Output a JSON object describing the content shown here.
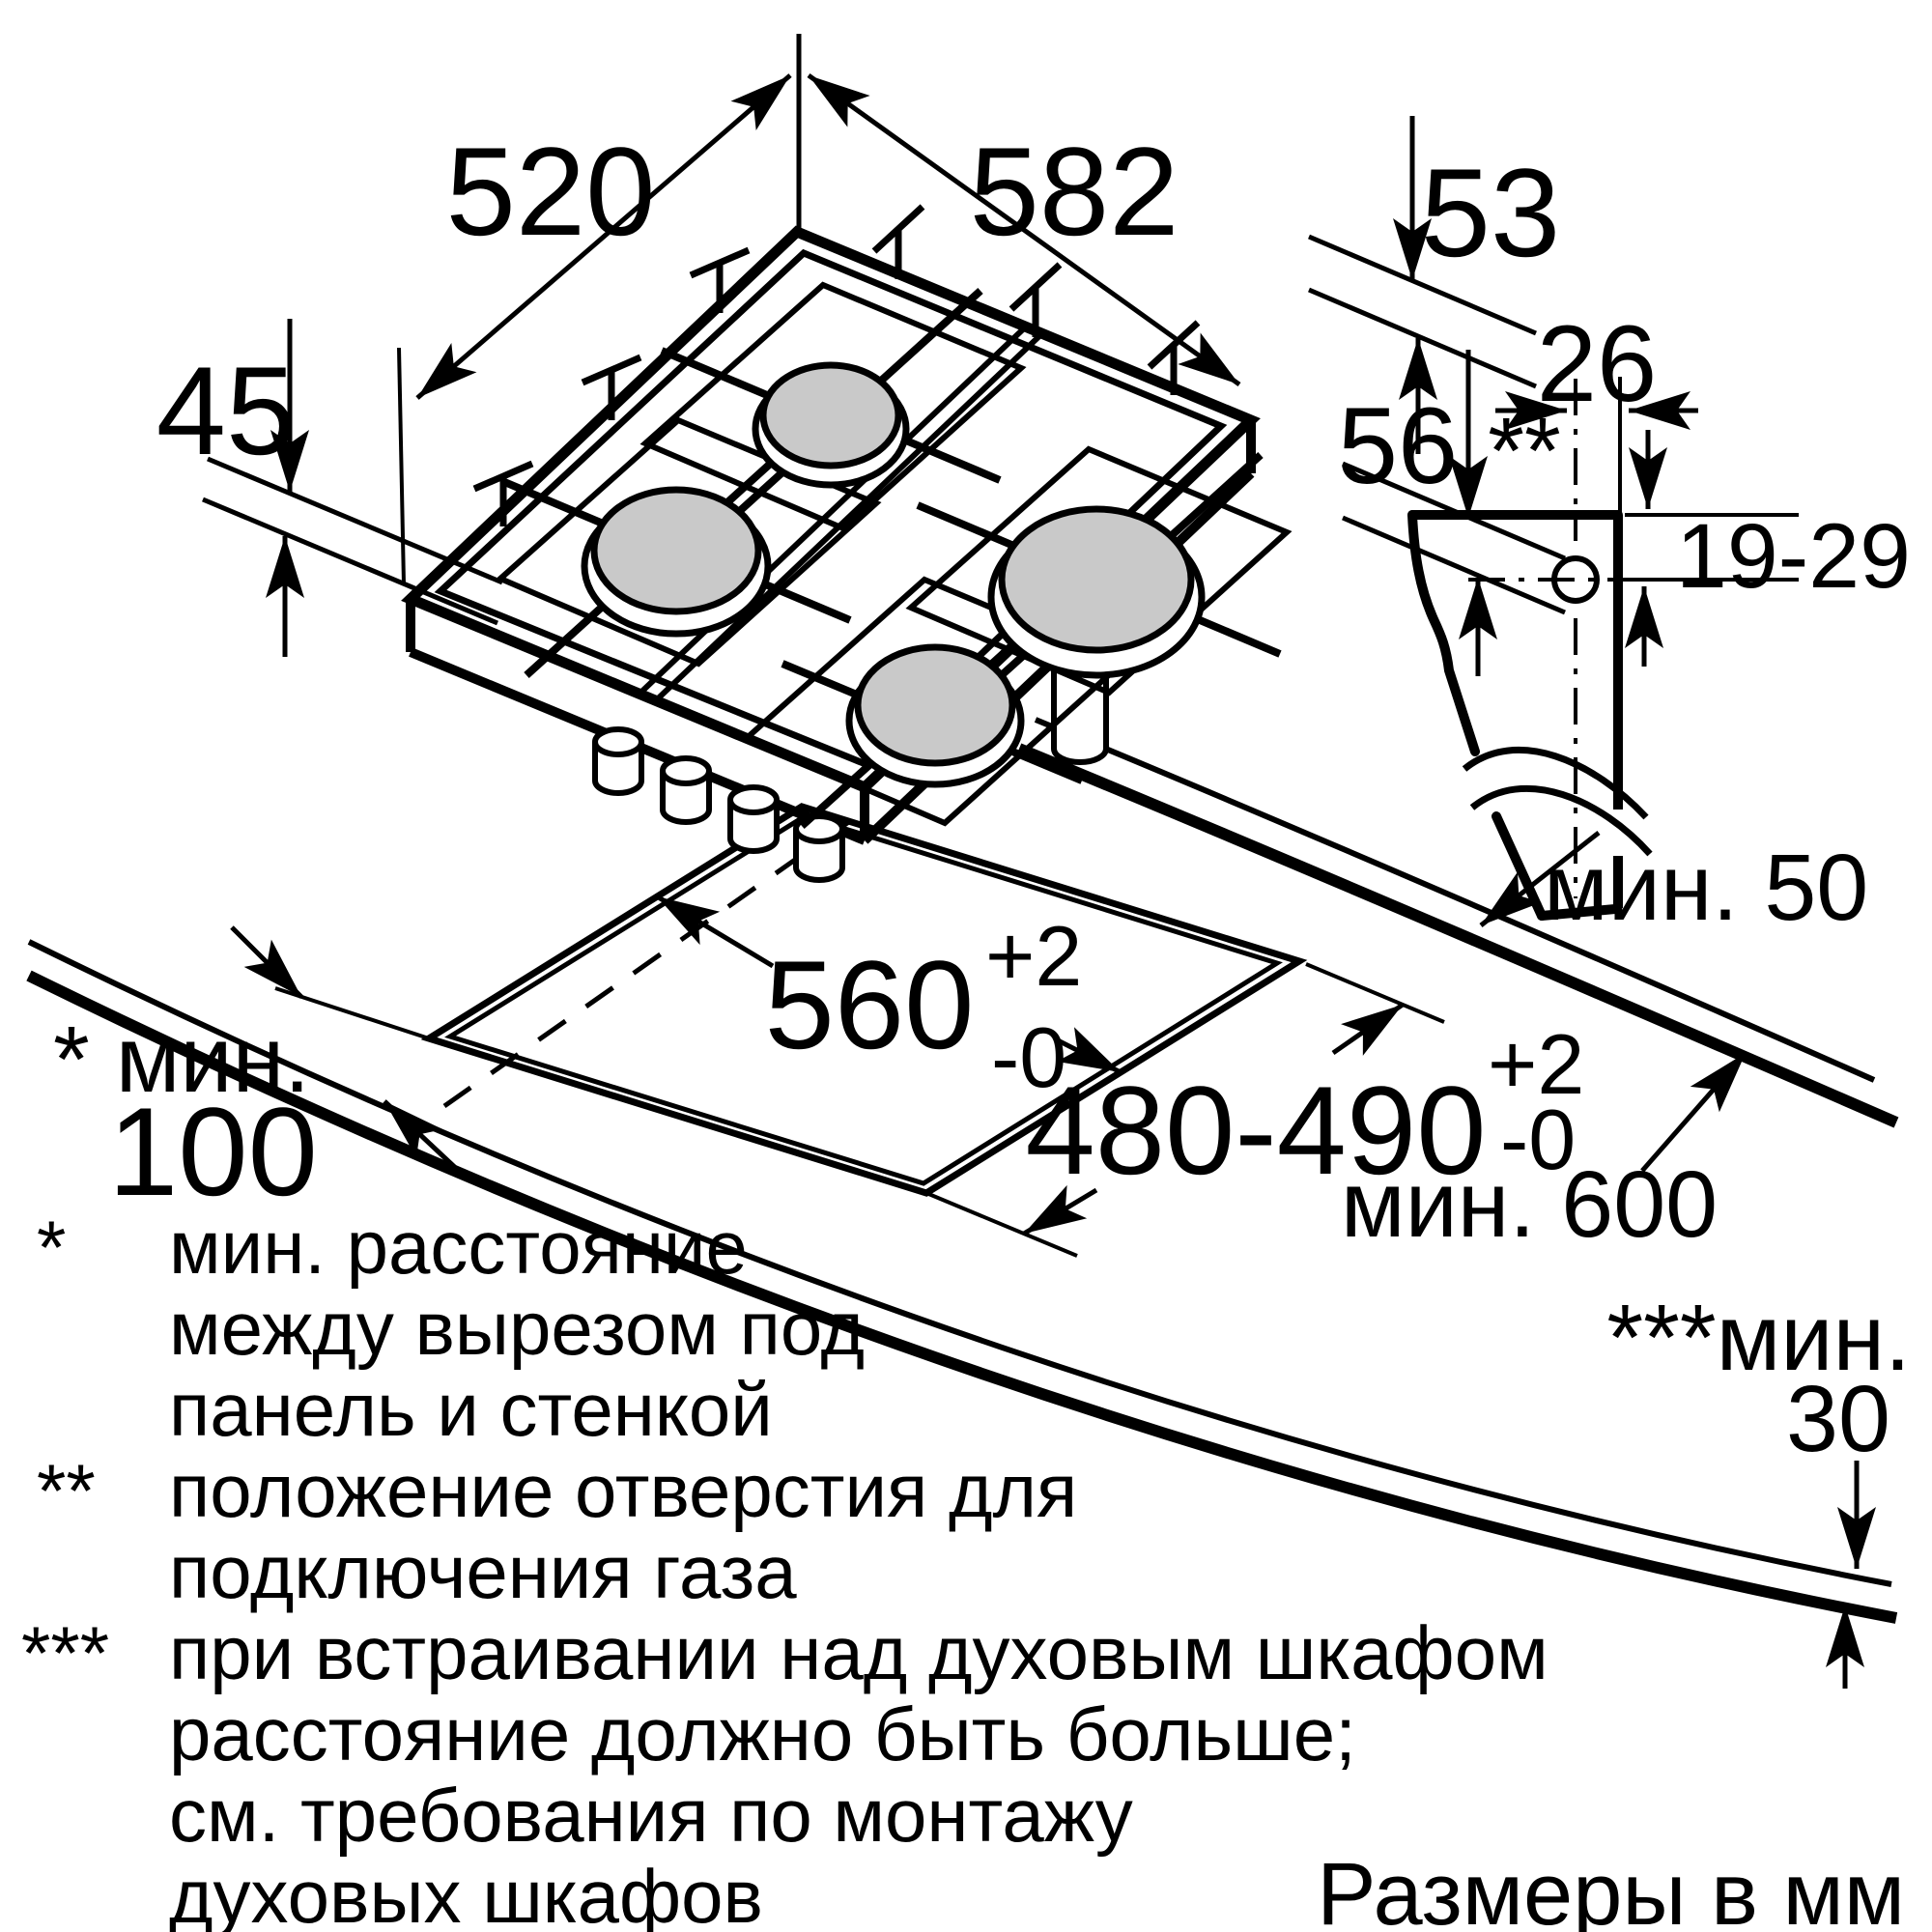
{
  "dims": {
    "hob_depth": "520",
    "hob_width": "582",
    "d53": "53",
    "d45": "45",
    "d56": "56",
    "d26": "26",
    "d19_29": "19-29",
    "cutout_width": "560",
    "cutout_width_plus": "+2",
    "cutout_width_minus": "-0",
    "cutout_depth": "480-490",
    "cutout_depth_plus": "+2",
    "cutout_depth_minus": "-0",
    "min50": "мин. 50",
    "min600": "мин. 600",
    "min100_label": "* мин.",
    "min100_value": "100",
    "min30_label": "***мин.",
    "min30_value": "30",
    "gas_hole_marker": "**"
  },
  "footnotes": {
    "marker1": "*",
    "line1": "мин. расстояние",
    "line2": "между вырезом под",
    "line3": "панель и стенкой",
    "marker2": "**",
    "line4": "положение отверстия для",
    "line5": "подключения газа",
    "marker3": "***",
    "line6": "при встраивании над духовым шкафом",
    "line7": "расстояние должно быть больше;",
    "line8": "см. требования по монтажу",
    "line9": "духовых шкафов"
  },
  "units_note": "Размеры в мм"
}
